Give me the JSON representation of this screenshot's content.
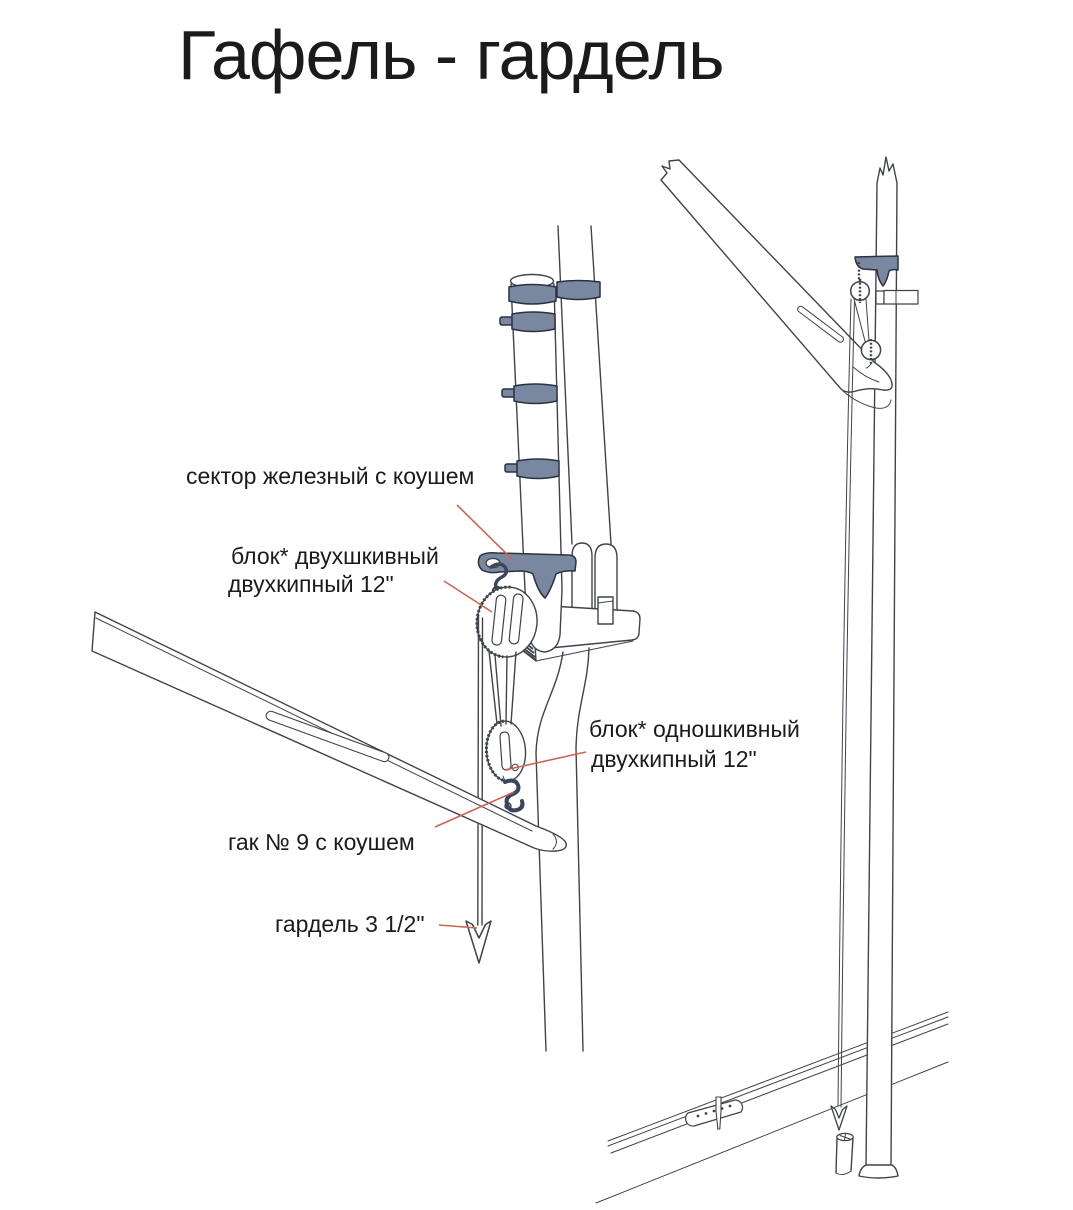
{
  "title": "Гафель - гардель",
  "labels": {
    "sector": "сектор железный с коушем",
    "block_double_line1": "блок* двухшкивный",
    "block_double_line2": "двухкипный 12\"",
    "block_single_line1": "блок* одношкивный",
    "block_single_line2": "двухкипный 12\"",
    "hook": "гак № 9 с коушем",
    "halyard": "гардель 3 1/2\""
  },
  "colors": {
    "accent_blue": "#7a87a1",
    "line": "#3f434a",
    "leader_red": "#cb6553",
    "text": "#1b1b19"
  }
}
